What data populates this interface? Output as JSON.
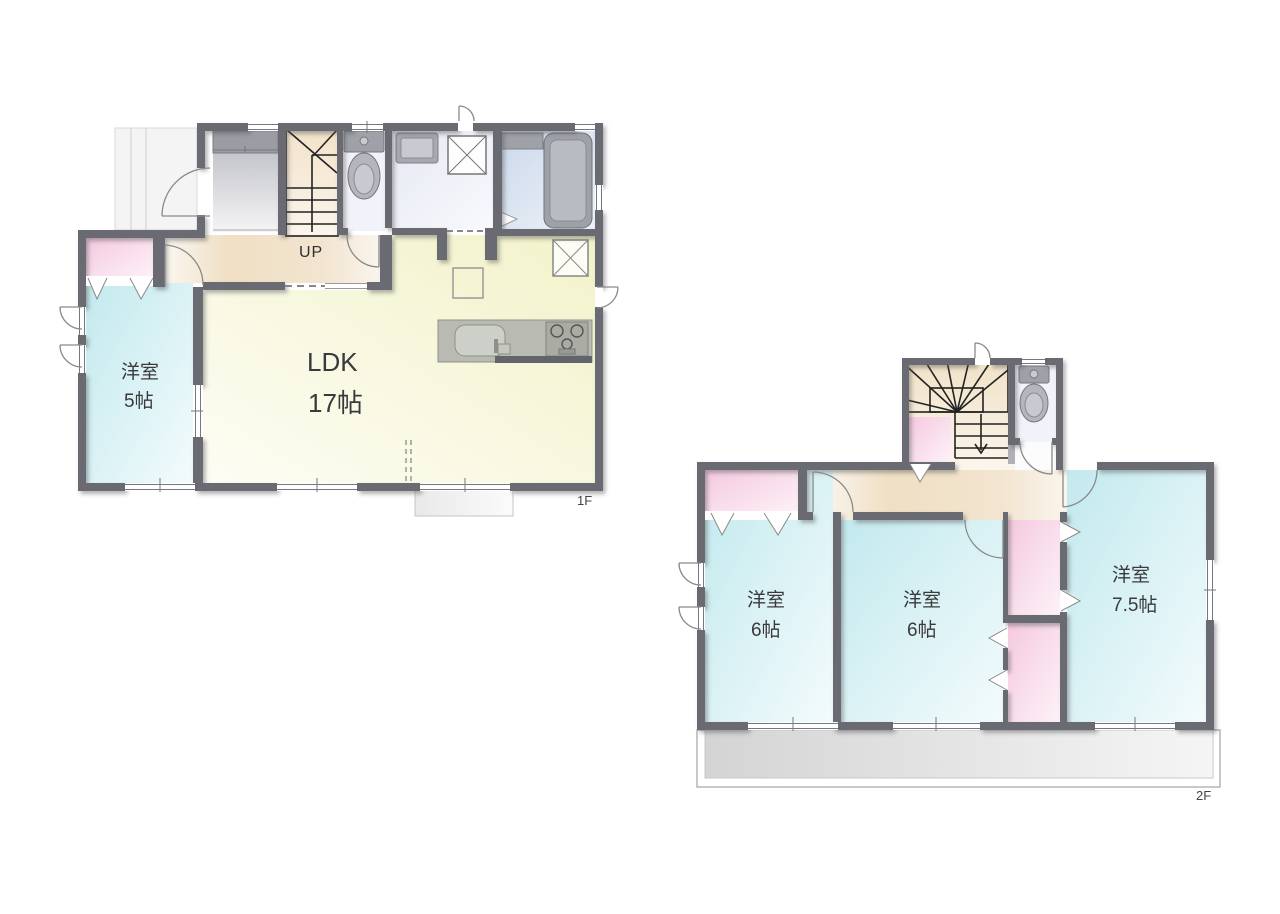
{
  "floor1": {
    "floor_label": "1F",
    "stairs_label": "UP",
    "room_yoshitsu": {
      "name": "洋室",
      "size": "5帖"
    },
    "room_ldk": {
      "name": "LDK",
      "size": "17帖"
    },
    "fixtures": [
      "stairs-up",
      "toilet",
      "washbasin",
      "washing-machine",
      "bathtub",
      "kitchen-sink",
      "stove",
      "refrigerator",
      "entrance-porch",
      "terrace"
    ]
  },
  "floor2": {
    "floor_label": "2F",
    "rooms": [
      {
        "name": "洋室",
        "size": "6帖"
      },
      {
        "name": "洋室",
        "size": "6帖"
      },
      {
        "name": "洋室",
        "size": "7.5帖"
      }
    ],
    "fixtures": [
      "stairs-down",
      "toilet",
      "balcony",
      "closets"
    ]
  },
  "colors": {
    "wall": "#696a72",
    "western_room": "#c9ebf0",
    "ldk": "#f3f3cd",
    "closet_pink": "#f5cade",
    "hall_cream": "#f0dfc4",
    "bathroom_blue": "#cbd8eb",
    "washroom": "#e7eaf4",
    "toilet_floor": "#f2f3fa",
    "fixture_gray": "#9fa1a9",
    "balcony_gray": "#d6d6d6"
  }
}
